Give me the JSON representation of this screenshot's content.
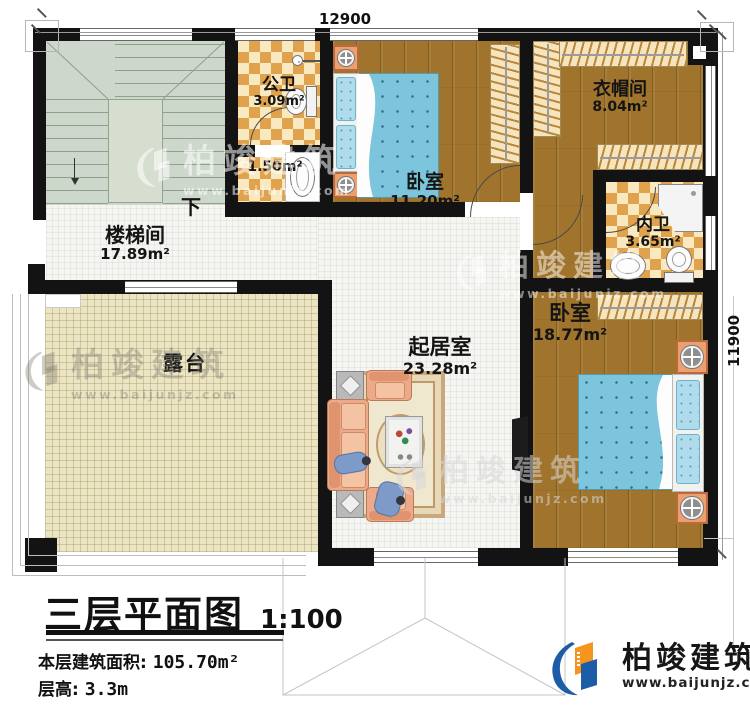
{
  "dimensions": {
    "width": "12900",
    "height": "11900"
  },
  "rooms": {
    "stairwell": {
      "name": "楼梯间",
      "area": "17.89m²"
    },
    "public_bath": {
      "name": "公卫",
      "area": "3.09m²"
    },
    "washroom": {
      "area": "1.50m²"
    },
    "bedroom_top": {
      "name": "卧室",
      "area": "11.20m²"
    },
    "cloakroom": {
      "name": "衣帽间",
      "area": "8.04m²"
    },
    "inner_bath": {
      "name": "内卫",
      "area": "3.65m²"
    },
    "bedroom_right": {
      "name": "卧室",
      "area": "18.77m²"
    },
    "living_room": {
      "name": "起居室",
      "area": "23.28m²"
    },
    "terrace": {
      "name": "露台"
    }
  },
  "stairs": {
    "down_label": "下"
  },
  "title_block": {
    "title": "三层平面图",
    "scale": "1:100",
    "area_label": "本层建筑面积:",
    "area_value": "105.70m²",
    "floor_height_label": "层高:",
    "floor_height_value": "3.3m"
  },
  "brand": {
    "name": "柏竣建筑",
    "website": "www.baijunjz.com"
  },
  "colors": {
    "wall": "#131313",
    "wood": "#a0742c",
    "checker_orange": "#e0a24c",
    "checker_cream": "#f8e9c0",
    "stair": "#cdd7cb",
    "terrace": "#ece5c4",
    "bed_blue": "#7cc5dc",
    "sofa": "#edaa8a",
    "brand_blue": "#1d5ca6",
    "brand_orange": "#f7941e"
  }
}
